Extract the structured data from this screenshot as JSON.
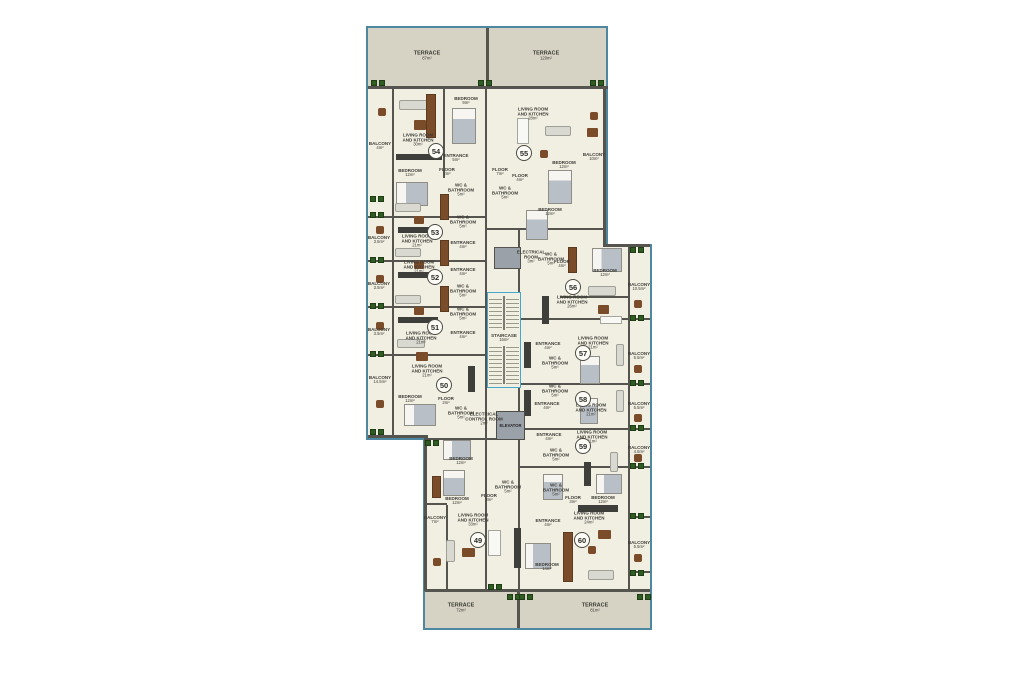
{
  "plan": {
    "colors": {
      "outline": "#4e87a0",
      "terrace_floor": "#d6d2c4",
      "interior_floor": "#f1eee2",
      "wall": "#55544e",
      "stairs_outline": "#44a7cb",
      "plant_green": "#2f5c22",
      "furniture_brown": "#7a4c2a",
      "elevator_gray": "#9ba1a8"
    },
    "terraces": [
      {
        "label": "TERRACE",
        "area": "87m²",
        "x": 427,
        "y": 56
      },
      {
        "label": "TERRACE",
        "area": "120m²",
        "x": 546,
        "y": 56
      },
      {
        "label": "TERRACE",
        "area": "72m²",
        "x": 461,
        "y": 608
      },
      {
        "label": "TERRACE",
        "area": "81m²",
        "x": 595,
        "y": 608
      }
    ],
    "units": [
      {
        "number": "54",
        "cx": 436,
        "cy": 151,
        "rooms": [
          {
            "t": "LIVING ROOM AND KITCHEN",
            "a": "30m²",
            "x": 418,
            "y": 140
          },
          {
            "t": "BEDROOM",
            "a": "9m²",
            "x": 466,
            "y": 101
          },
          {
            "t": "BEDROOM",
            "a": "12m²",
            "x": 410,
            "y": 173
          },
          {
            "t": "ENTRANCE",
            "a": "5m²",
            "x": 456,
            "y": 158
          },
          {
            "t": "FLOOR",
            "a": "2m²",
            "x": 447,
            "y": 172
          },
          {
            "t": "WC & BATHROOM",
            "a": "5m²",
            "x": 461,
            "y": 190
          }
        ]
      },
      {
        "number": "55",
        "cx": 524,
        "cy": 153,
        "rooms": [
          {
            "t": "LIVING ROOM AND KITCHEN",
            "a": "28m²",
            "x": 533,
            "y": 114
          },
          {
            "t": "FLOOR",
            "a": "4m²",
            "x": 520,
            "y": 178
          },
          {
            "t": "BEDROOM",
            "a": "12m²",
            "x": 564,
            "y": 165
          },
          {
            "t": "BEDROOM",
            "a": "12m²",
            "x": 550,
            "y": 212
          },
          {
            "t": "WC & BATHROOM",
            "a": "5m²",
            "x": 505,
            "y": 193
          }
        ]
      },
      {
        "number": "53",
        "cx": 435,
        "cy": 232,
        "rooms": [
          {
            "t": "LIVING ROOM AND KITCHEN",
            "a": "21m²",
            "x": 417,
            "y": 241
          },
          {
            "t": "ENTRANCE",
            "a": "4m²",
            "x": 463,
            "y": 245
          },
          {
            "t": "WC & BATHROOM",
            "a": "5m²",
            "x": 463,
            "y": 222
          }
        ]
      },
      {
        "number": "52",
        "cx": 435,
        "cy": 277,
        "rooms": [
          {
            "t": "LIVING ROOM AND KITCHEN",
            "a": "21m²",
            "x": 419,
            "y": 267
          },
          {
            "t": "ENTRANCE",
            "a": "4m²",
            "x": 463,
            "y": 272
          },
          {
            "t": "WC & BATHROOM",
            "a": "5m²",
            "x": 463,
            "y": 291
          }
        ]
      },
      {
        "number": "51",
        "cx": 435,
        "cy": 327,
        "rooms": [
          {
            "t": "LIVING ROOM AND KITCHEN",
            "a": "21m²",
            "x": 421,
            "y": 338
          },
          {
            "t": "ENTRANCE",
            "a": "4m²",
            "x": 463,
            "y": 335
          },
          {
            "t": "WC & BATHROOM",
            "a": "5m²",
            "x": 463,
            "y": 314
          }
        ]
      },
      {
        "number": "50",
        "cx": 444,
        "cy": 385,
        "rooms": [
          {
            "t": "LIVING ROOM AND KITCHEN",
            "a": "21m²",
            "x": 427,
            "y": 371
          },
          {
            "t": "BEDROOM",
            "a": "12m²",
            "x": 410,
            "y": 399
          },
          {
            "t": "FLOOR",
            "a": "2m²",
            "x": 446,
            "y": 401
          },
          {
            "t": "WC & BATHROOM",
            "a": "5m²",
            "x": 461,
            "y": 413
          }
        ]
      },
      {
        "number": "49",
        "cx": 478,
        "cy": 540,
        "rooms": [
          {
            "t": "LIVING ROOM AND KITCHEN",
            "a": "33m²",
            "x": 473,
            "y": 520
          },
          {
            "t": "BEDROOM",
            "a": "12m²",
            "x": 461,
            "y": 461
          },
          {
            "t": "BEDROOM",
            "a": "12m²",
            "x": 457,
            "y": 501
          },
          {
            "t": "FLOOR",
            "a": "3m²",
            "x": 489,
            "y": 498
          },
          {
            "t": "WC & BATHROOM",
            "a": "5m²",
            "x": 508,
            "y": 487
          }
        ]
      },
      {
        "number": "56",
        "cx": 573,
        "cy": 287,
        "rooms": [
          {
            "t": "LIVING ROOM AND KITCHEN",
            "a": "26m²",
            "x": 572,
            "y": 302
          },
          {
            "t": "BEDROOM",
            "a": "12m²",
            "x": 605,
            "y": 273
          },
          {
            "t": "FLOOR",
            "a": "4m²",
            "x": 562,
            "y": 264
          },
          {
            "t": "WC & BATHROOM",
            "a": "5m²",
            "x": 551,
            "y": 259
          }
        ]
      },
      {
        "number": "57",
        "cx": 583,
        "cy": 353,
        "rooms": [
          {
            "t": "LIVING ROOM AND KITCHEN",
            "a": "21m²",
            "x": 593,
            "y": 343
          },
          {
            "t": "ENTRANCE",
            "a": "4m²",
            "x": 548,
            "y": 346
          },
          {
            "t": "WC & BATHROOM",
            "a": "5m²",
            "x": 555,
            "y": 363
          }
        ]
      },
      {
        "number": "58",
        "cx": 583,
        "cy": 399,
        "rooms": [
          {
            "t": "LIVING ROOM AND KITCHEN",
            "a": "21m²",
            "x": 591,
            "y": 410
          },
          {
            "t": "ENTRANCE",
            "a": "4m²",
            "x": 547,
            "y": 406
          },
          {
            "t": "WC & BATHROOM",
            "a": "5m²",
            "x": 555,
            "y": 391
          }
        ]
      },
      {
        "number": "59",
        "cx": 583,
        "cy": 446,
        "rooms": [
          {
            "t": "LIVING ROOM AND KITCHEN",
            "a": "21m²",
            "x": 592,
            "y": 437
          },
          {
            "t": "ENTRANCE",
            "a": "4m²",
            "x": 549,
            "y": 437
          },
          {
            "t": "WC & BATHROOM",
            "a": "5m²",
            "x": 556,
            "y": 455
          }
        ]
      },
      {
        "number": "60",
        "cx": 582,
        "cy": 540,
        "rooms": [
          {
            "t": "LIVING ROOM AND KITCHEN",
            "a": "24m²",
            "x": 589,
            "y": 518
          },
          {
            "t": "ENTRANCE",
            "a": "4m²",
            "x": 548,
            "y": 523
          },
          {
            "t": "BEDROOM",
            "a": "12m²",
            "x": 603,
            "y": 500
          },
          {
            "t": "BEDROOM",
            "a": "14m²",
            "x": 547,
            "y": 567
          },
          {
            "t": "FLOOR",
            "a": "3m²",
            "x": 573,
            "y": 500
          },
          {
            "t": "WC & BATHROOM",
            "a": "5m²",
            "x": 556,
            "y": 490
          }
        ]
      }
    ],
    "balconies": [
      {
        "label": "BALCONY",
        "area": "4m²",
        "x": 380,
        "y": 146
      },
      {
        "label": "BALCONY",
        "area": "3.5m²",
        "x": 379,
        "y": 240
      },
      {
        "label": "BALCONY",
        "area": "3.5m²",
        "x": 379,
        "y": 286
      },
      {
        "label": "BALCONY",
        "area": "3.5m²",
        "x": 379,
        "y": 332
      },
      {
        "label": "BALCONY",
        "area": "14.5m²",
        "x": 380,
        "y": 380
      },
      {
        "label": "BALCONY",
        "area": "7m²",
        "x": 435,
        "y": 520
      },
      {
        "label": "BALCONY",
        "area": "10m²",
        "x": 594,
        "y": 157
      },
      {
        "label": "BALCONY",
        "area": "10.5m²",
        "x": 639,
        "y": 287
      },
      {
        "label": "BALCONY",
        "area": "5.5m²",
        "x": 639,
        "y": 356
      },
      {
        "label": "BALCONY",
        "area": "5.5m²",
        "x": 639,
        "y": 406
      },
      {
        "label": "BALCONY",
        "area": "4.5m²",
        "x": 639,
        "y": 450
      },
      {
        "label": "BALCONY",
        "area": "5.5m²",
        "x": 639,
        "y": 545
      }
    ],
    "core": {
      "stairs": {
        "label": "STAIRCASE",
        "area": "15m²",
        "x": 504,
        "y": 338
      },
      "elevator": {
        "label": "ELEVATOR",
        "x": 509,
        "y": 424
      },
      "rooms": [
        {
          "t": "ELECTRICAL CONTROL ROOM",
          "a": "2m²",
          "x": 484,
          "y": 419
        },
        {
          "t": "ELECTRICAL ROOM",
          "a": "3m²",
          "x": 531,
          "y": 257
        },
        {
          "t": "FLOOR",
          "a": "7m²",
          "x": 500,
          "y": 172
        }
      ]
    }
  }
}
